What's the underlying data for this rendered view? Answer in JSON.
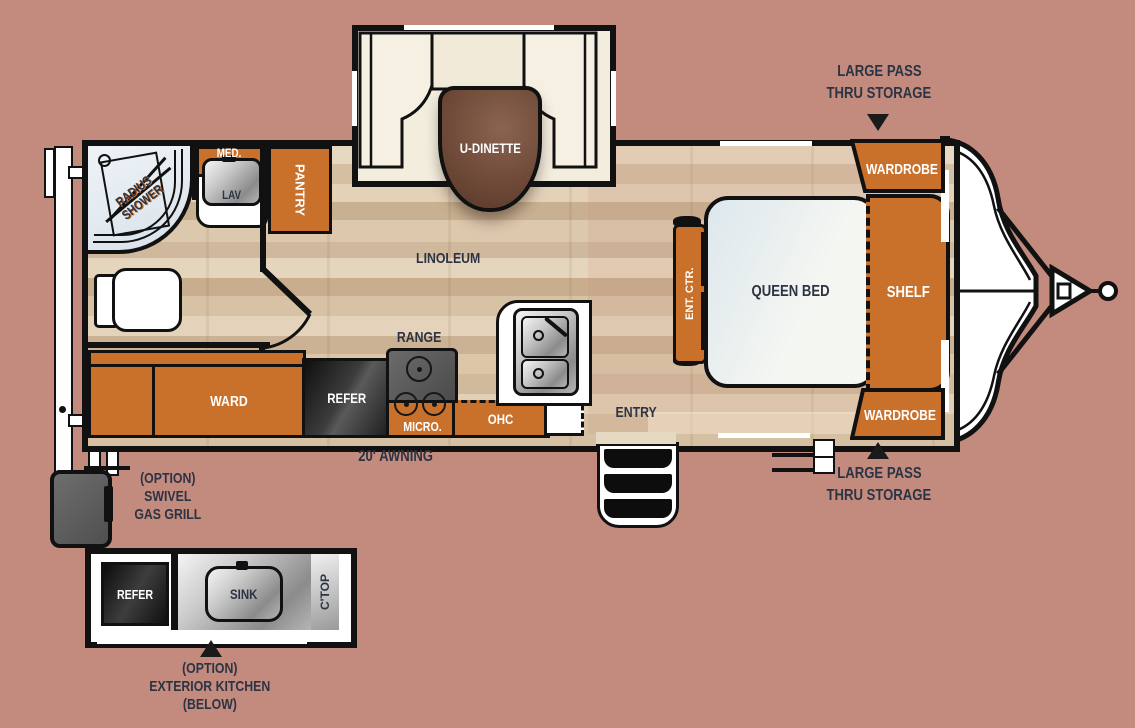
{
  "title": "Travel trailer floor plan",
  "colors": {
    "background": "#c28b7e",
    "cabinet_orange": "#c9702b",
    "wall_black": "#111111",
    "label_navy": "#2c3343",
    "bench_cream": "#f3edde",
    "table_brown": "#6f4a38",
    "bed_white": "#eef2f1",
    "floor_tan": "#dcc8ac"
  },
  "slideout": {
    "dinette": "U-DINETTE"
  },
  "bathroom": {
    "shower_line1": "RADIUS",
    "shower_line2": "SHOWER",
    "med": "MED.",
    "lav": "LAV"
  },
  "kitchen": {
    "pantry": "PANTRY",
    "range": "RANGE",
    "refer": "REFER",
    "micro": "MICRO.",
    "ohc": "OHC",
    "ward": "WARD"
  },
  "living": {
    "linoleum": "LINOLEUM",
    "ent_ctr": "ENT. CTR."
  },
  "bedroom": {
    "queen_bed": "QUEEN BED",
    "shelf": "SHELF",
    "wardrobe_top": "WARDROBE",
    "wardrobe_bottom": "WARDROBE"
  },
  "exterior": {
    "awning": "20' AWNING",
    "entry": "ENTRY",
    "pass_thru_top": {
      "line1": "LARGE PASS",
      "line2": "THRU STORAGE"
    },
    "pass_thru_bottom": {
      "line1": "LARGE PASS",
      "line2": "THRU STORAGE"
    },
    "grill_option": {
      "line1": "(OPTION)",
      "line2": "SWIVEL",
      "line3": "GAS GRILL"
    },
    "ext_kitchen": {
      "refer": "REFER",
      "sink": "SINK",
      "ctop": "C'TOP",
      "cap1": "(OPTION)",
      "cap2": "EXTERIOR KITCHEN",
      "cap3": "(BELOW)"
    }
  }
}
